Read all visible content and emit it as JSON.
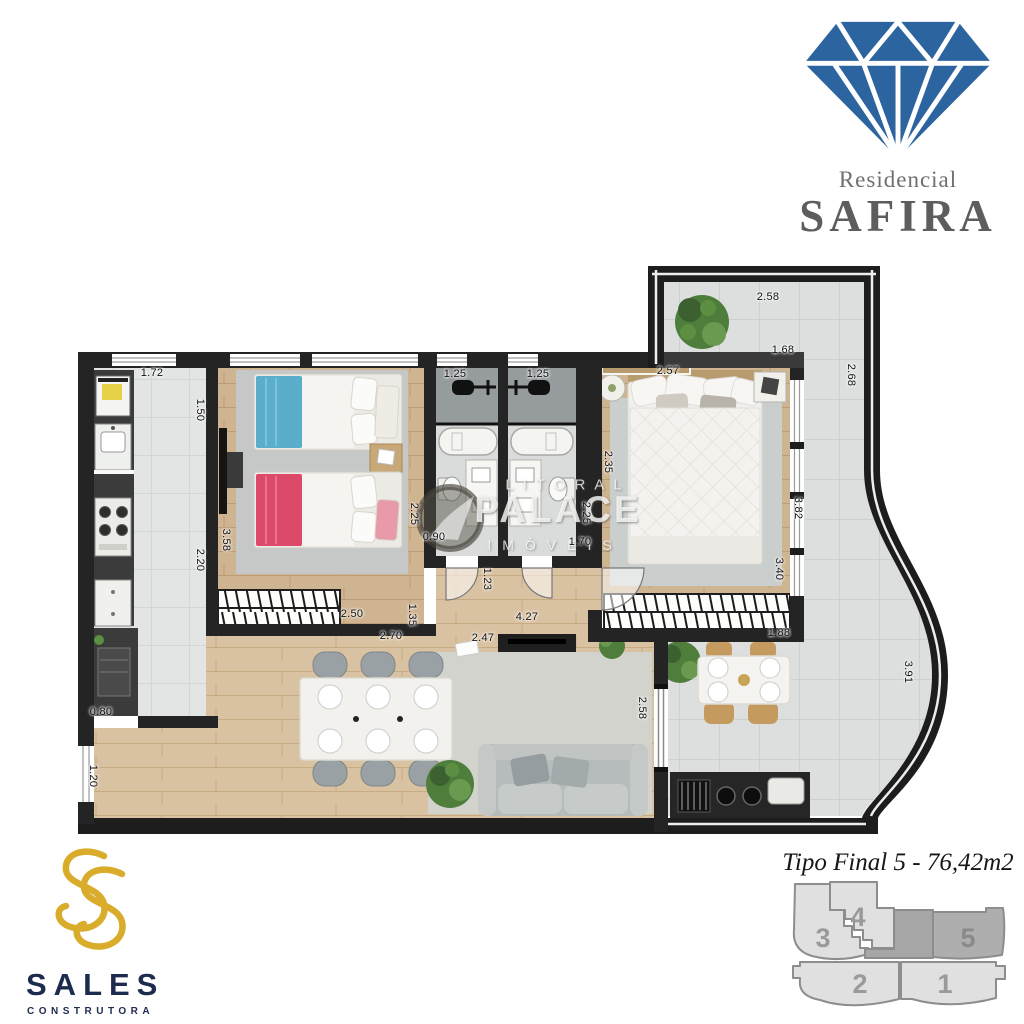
{
  "branding": {
    "safira": {
      "line1": "Residencial",
      "name": "SAFIRA",
      "diamond_color": "#2c64a0",
      "text_color": "#5d5d5d"
    },
    "sales": {
      "name": "SALES",
      "subtitle": "CONSTRUTORA",
      "gold": "#d9ac2c",
      "navy": "#1d2c4e"
    }
  },
  "watermark": {
    "line1": "LITORAL",
    "line2": "PALACE",
    "line3": "IMÓVEIS"
  },
  "plan": {
    "title": "Tipo Final 5 - 76,42m2",
    "dims": {
      "terrace_top": "2.58",
      "terrace_inner": "1.68",
      "terrace_right": "2.68",
      "kitchen_top": "1.72",
      "kitchen_upper": "1.50",
      "kitchen_lower": "2.20",
      "bedroom2_left": "3.58",
      "bath1_top": "1.25",
      "bath2_top": "1.25",
      "bath1_side": "2.25",
      "bath2_side": "2.25",
      "bath_door": "0.90",
      "master_top": "2.57",
      "master_left": "2.35",
      "master_right_upper": "3.82",
      "master_right_lower": "3.40",
      "hall_width": "1.70",
      "hall_depth": "1.23",
      "living_length": "4.27",
      "living_top": "2.47",
      "wardrobe2_width": "2.50",
      "dining_top": "2.70",
      "wardrobe_side": "1.35",
      "kitchen_bottom": "0.80",
      "left_lower": "1.20",
      "terrace_door": "2.58",
      "terrace_table": "1.88",
      "terrace_curve": "3.91"
    }
  },
  "keyplan": {
    "highlighted_unit": "5",
    "numbers": {
      "u1": "1",
      "u2": "2",
      "u3": "3",
      "u4": "4",
      "u5": "5"
    }
  }
}
